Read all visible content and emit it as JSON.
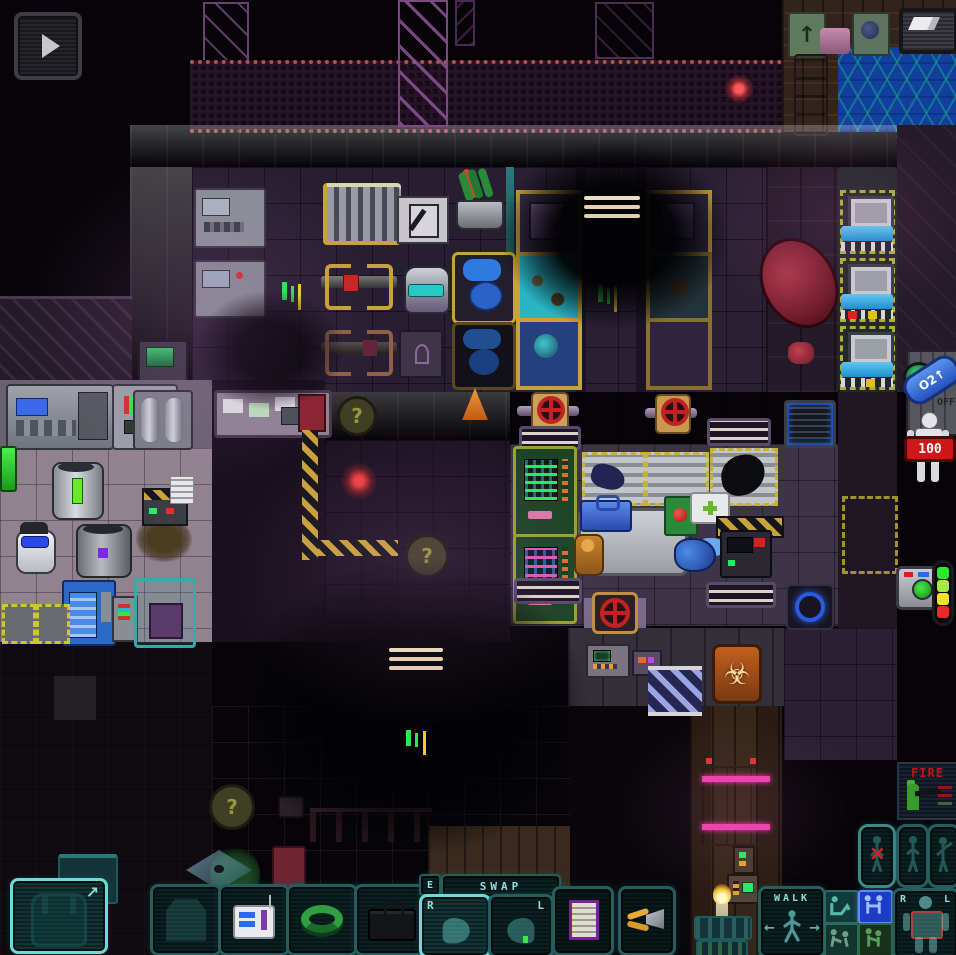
{
  "game_title": "Space Station 13",
  "colors": {
    "hud_teal": "#2e6f6f",
    "hud_teal_bright": "#7fe0e0",
    "intent_selected_blue": "#2a50e0",
    "health_badge_red": "#cc1818",
    "magenta_door": "#ef3fae",
    "biohazard_orange": "#c06020",
    "tank_pill_blue": "#3a6ae0"
  },
  "top_hud": {
    "toggle_button_icon": "play-arrow",
    "wiki_button_icon": "paper-page"
  },
  "right_hud": {
    "tank_indicator": {
      "label": "O2↑"
    },
    "health_doll": {
      "value": "100"
    },
    "camera_button": {
      "icon": "camera"
    },
    "health_bar_segments": [
      "#2ee62e",
      "#a6e84a",
      "#f0e22a",
      "#e82a2a"
    ]
  },
  "bottom_hud": {
    "backpack_slot": {
      "icon": "backpack",
      "corner_arrow": "↗"
    },
    "equip_slots": [
      {
        "name": "suit",
        "icon": "armor-silhouette"
      },
      {
        "name": "device",
        "icon": "white-medical-device"
      },
      {
        "name": "belt",
        "icon": "green-utility-belt"
      },
      {
        "name": "bag",
        "icon": "black-briefcase"
      }
    ],
    "swap": {
      "key_hint": "E",
      "label": "SWAP"
    },
    "hands": {
      "right_label": "R",
      "left_label": "L",
      "active_hand": "right"
    },
    "item_slots": [
      {
        "icon": "paper-document"
      },
      {
        "icon": "wirecutters"
      }
    ],
    "walk_button": {
      "label": "WALK",
      "left_arrow": "←",
      "right_arrow": "→"
    },
    "intents": [
      {
        "name": "help"
      },
      {
        "name": "grab",
        "selected": true
      },
      {
        "name": "disarm"
      },
      {
        "name": "harm"
      }
    ],
    "doll_panel": {
      "right_label": "R",
      "left_label": "L"
    },
    "side_buttons": [
      {
        "name": "rest",
        "overlay": "×"
      },
      {
        "name": "pull"
      },
      {
        "name": "point"
      }
    ]
  },
  "world": {
    "question_marker": "?",
    "fire_poster": {
      "title": "FIRE"
    },
    "cryo_console_label": "OFF",
    "arrow_sign": "↑",
    "biohazard_symbol": "☣",
    "notable_objects": [
      "medical beds",
      "operating tables",
      "nanomed vendors",
      "chem lab machines",
      "canisters",
      "medibots",
      "radiator",
      "potted plant",
      "pink quarantine door",
      "biohazard sign",
      "blast shutter window",
      "gas valves",
      "air vents",
      "smoke clouds",
      "glass table",
      "vending machine"
    ]
  }
}
